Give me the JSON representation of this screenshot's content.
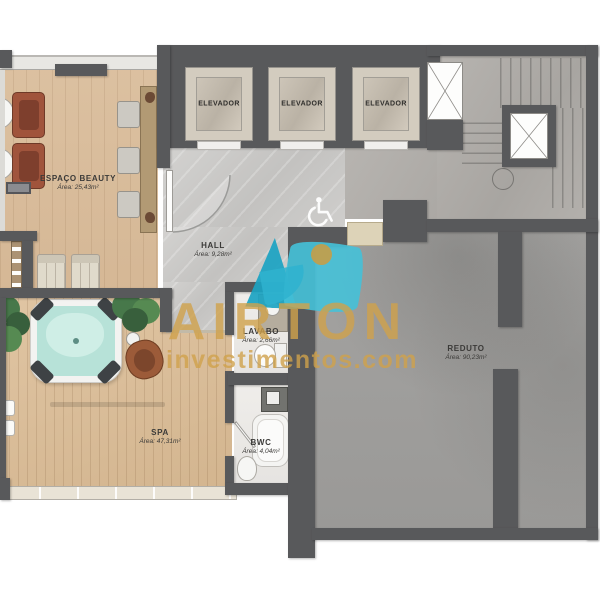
{
  "plan_title": "pavement floor plan",
  "rooms": {
    "beauty": {
      "name": "ESPAÇO BEAUTY",
      "area": "Área: 25,43m²"
    },
    "hall": {
      "name": "HALL",
      "area": "Área: 9,28m²"
    },
    "lavabo": {
      "name": "LAVABO",
      "area": "Área: 2,66m²"
    },
    "spa": {
      "name": "SPA",
      "area": "Área: 47,31m²"
    },
    "bwc": {
      "name": "BWC",
      "area": "Área: 4,04m²"
    },
    "reduto": {
      "name": "REDUTO",
      "area": "Área: 90,23m²"
    }
  },
  "elevators": [
    "ELEVADOR",
    "ELEVADOR",
    "ELEVADOR"
  ],
  "watermark": {
    "brand": "AIRTON",
    "site": "investimentos.com"
  },
  "icons": {
    "wheelchair": "accessible route"
  },
  "colors": {
    "wall": "#58595b",
    "wood": "#d9bd9c",
    "marble": "#cbcac8",
    "concrete": "#a09f9d",
    "water": "#b7e2d8",
    "logo_teal": "#2fb3cf",
    "logo_teal_dark": "#1ba3c2",
    "watermark_gold": "#cfa14b",
    "chair_red": "#a0543c",
    "counter_tan": "#b29a74",
    "plant_green": "#47784a"
  }
}
